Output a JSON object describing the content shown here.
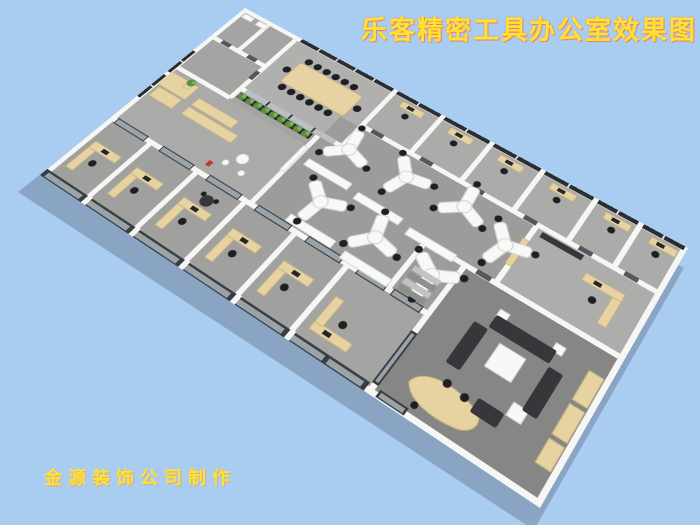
{
  "title": {
    "text": "乐客精密工具办公室效果图"
  },
  "watermark": {
    "text": "金源装饰公司制作"
  },
  "scene": {
    "background_color": "#a9cdf1",
    "colors": {
      "wall": "#f6f6f4",
      "floor": "#a4a4a2",
      "floor_conference": "#b0b0ae",
      "floor_open": "#9c9c9a",
      "floor_exec": "#868684",
      "window": "#2c2d2f",
      "glass": "#9aa3a8",
      "glass_frame": "#3a3e42",
      "wood": "#e7d3a2",
      "wood_edge": "#c9b37f",
      "white_furniture": "#f8f8f6",
      "chair": "#1f1f21",
      "sofa": "#37373b",
      "door": "#565660",
      "plant": "#5d8f3f",
      "plant_light": "#7db45a",
      "planter": "#2a2a2a",
      "red_accent": "#c0392b",
      "title_yellow": "#ffe12e",
      "title_glow": "#ff5a3a",
      "shadow": "rgba(70,80,100,0.32)"
    },
    "areas": [
      {
        "name": "restroom-block"
      },
      {
        "name": "conference-room"
      },
      {
        "name": "reception-lounge"
      },
      {
        "name": "open-office"
      },
      {
        "name": "private-offices-top"
      },
      {
        "name": "private-offices-bottom"
      },
      {
        "name": "stair-storage-room"
      },
      {
        "name": "manager-office"
      },
      {
        "name": "executive-lounge-office"
      }
    ],
    "furniture_counts": {
      "y_shaped_desks": 7,
      "conference_chairs": 14,
      "perimeter_offices_top": 6,
      "perimeter_offices_bottom": 6,
      "sofa_sections": 4,
      "plants_in_planter": 9
    }
  }
}
